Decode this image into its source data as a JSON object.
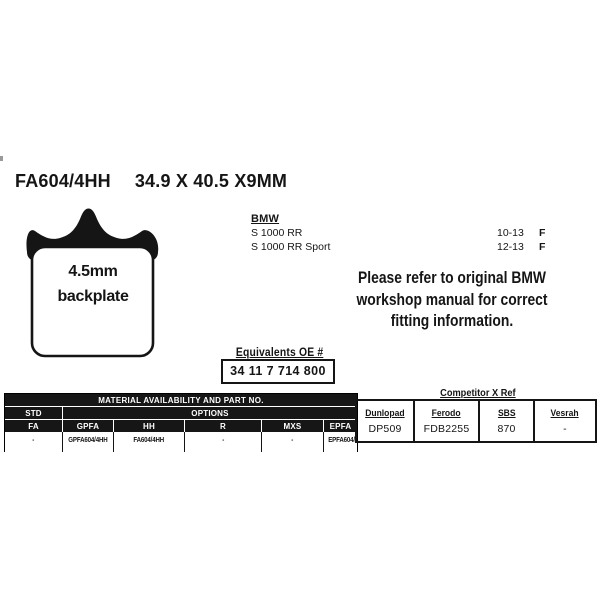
{
  "title": {
    "part_number": "FA604/4HH",
    "dimensions": "34.9 X 40.5 X9MM"
  },
  "pad": {
    "label_line1": "4.5mm",
    "label_line2": "backplate"
  },
  "fitment": {
    "make": "BMW",
    "rows": [
      {
        "model": "S 1000 RR",
        "years": "10-13",
        "position": "F"
      },
      {
        "model": "S 1000 RR Sport",
        "years": "12-13",
        "position": "F"
      }
    ]
  },
  "note": {
    "line1": "Please refer to original BMW",
    "line2": "workshop manual for correct",
    "line3": "fitting information."
  },
  "equivalents": {
    "label": "Equivalents OE #",
    "value": "34 11 7 714 800"
  },
  "material_table": {
    "title": "MATERIAL AVAILABILITY AND PART NO.",
    "std_label": "STD",
    "options_label": "OPTIONS",
    "columns": [
      "FA",
      "GPFA",
      "HH",
      "R",
      "MXS",
      "EPFA"
    ],
    "values": [
      "-",
      "GPFA604/4HH",
      "FA604/4HH",
      "-",
      "-",
      "EPFA604/4HH"
    ]
  },
  "competitor_table": {
    "title": "Competitor X Ref",
    "columns": [
      "Dunlopad",
      "Ferodo",
      "SBS",
      "Vesrah"
    ],
    "values": [
      "DP509",
      "FDB2255",
      "870",
      "-"
    ]
  },
  "colors": {
    "ink": "#151515",
    "header_bg": "#161616",
    "background": "#ffffff"
  }
}
